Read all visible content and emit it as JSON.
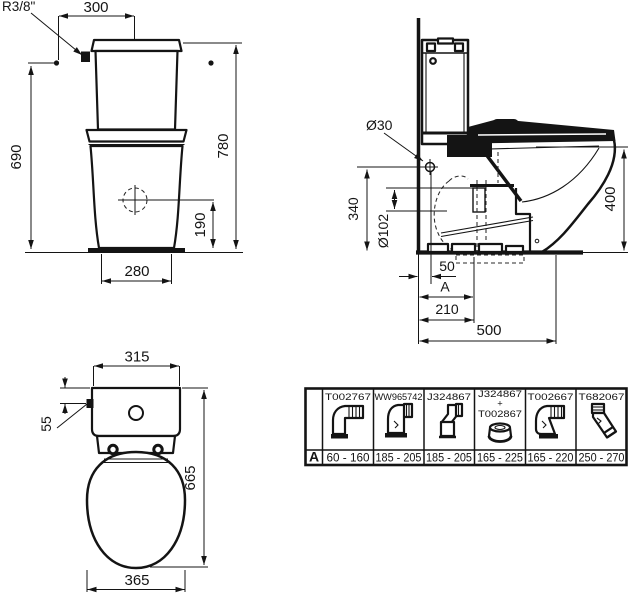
{
  "front_view": {
    "inlet_thread": "R3/8\"",
    "inlet_offset_x": "300",
    "total_height": "780",
    "inlet_height": "690",
    "flush_entry_height": "190",
    "base_width": "280"
  },
  "side_view": {
    "inlet_diameter": "Ø30",
    "inlet_height": "340",
    "outlet_diameter": "Ø102",
    "bowl_height": "400",
    "wall_to_inlet": "50",
    "adjustable_distance_label": "A",
    "outlet_distance": "210",
    "total_depth": "500"
  },
  "top_view": {
    "cistern_width": "315",
    "inlet_offset": "55",
    "total_depth": "665",
    "bowl_width": "365"
  },
  "connector_table": {
    "row_label": "A",
    "columns": [
      {
        "code_lines": [
          "T002767"
        ],
        "range": "60 - 160",
        "icon": "elbow-corrugated-connector"
      },
      {
        "code_lines": [
          "WW965742"
        ],
        "range": "185 - 205",
        "icon": "vertical-connector"
      },
      {
        "code_lines": [
          "J324867"
        ],
        "range": "185 - 205",
        "icon": "angled-connector"
      },
      {
        "code_lines": [
          "J324867",
          "+",
          "T002867"
        ],
        "range": "165 - 225",
        "icon": "offset-adapter"
      },
      {
        "code_lines": [
          "T002667"
        ],
        "range": "165 - 220",
        "icon": "elbow-corrugated-connector-2"
      },
      {
        "code_lines": [
          "T682067"
        ],
        "range": "250 - 270",
        "icon": "angled-corrugated-connector"
      }
    ]
  }
}
